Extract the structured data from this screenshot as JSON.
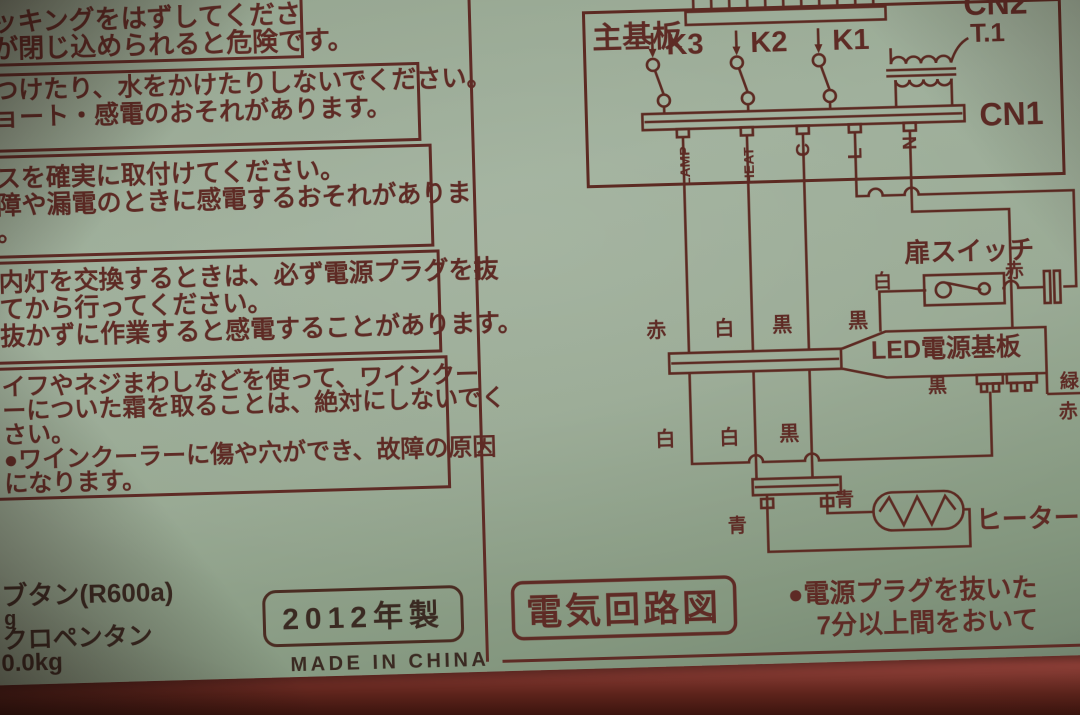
{
  "colors": {
    "label_bg": "#97a892",
    "ink": "#5e2b25",
    "ink_dark": "#3a2a22",
    "appliance_red": "#b4584c"
  },
  "warnings": [
    {
      "lines": [
        "ッキングをはずしてくださ",
        "が閉じ込められると危険です。"
      ]
    },
    {
      "lines": [
        "つけたり、水をかけたりしないでください。",
        "ョート・感電のおそれがあります。"
      ]
    },
    {
      "lines": [
        "スを確実に取付けてください。",
        "障や漏電のときに感電するおそれがありま",
        "。"
      ]
    },
    {
      "lines": [
        "内灯を交換するときは、必ず電源プラグを抜",
        "てから行ってください。",
        "抜かずに作業すると感電することがあります。"
      ]
    },
    {
      "lines": [
        "イフやネジまわしなどを使って、ワインクー",
        "ーについた霜を取ることは、絶対にしないでく",
        "さい。",
        "●ワインクーラーに傷や穴ができ、故障の原因",
        "になります。"
      ]
    }
  ],
  "specs": {
    "line1": "ブタン(R600a)",
    "line2": "g",
    "line3": "クロペンタン",
    "line4": "0.0kg"
  },
  "manufacture": {
    "year": "2012年製",
    "origin": "MADE IN CHINA"
  },
  "circuit": {
    "title": "電気回路図",
    "main_board": "主基板",
    "cn2": "CN2",
    "cn1": "CN1",
    "transformer": "T.1",
    "relays": [
      "K3",
      "K2",
      "K1"
    ],
    "pins": [
      "LAMP",
      "HEAT",
      "C",
      "L",
      "N"
    ],
    "wire_row1": [
      "赤",
      "白",
      "黒",
      "黒"
    ],
    "wire_row2": [
      "白",
      "白",
      "黒"
    ],
    "door_switch": {
      "label": "扉スイッチ",
      "white": "白",
      "red": "赤"
    },
    "led_board": {
      "label": "LED電源基板",
      "black": "黒",
      "green": "緑",
      "red": "赤"
    },
    "heater": {
      "label": "ヒーター",
      "blue1": "青",
      "blue2": "青"
    },
    "note": [
      "●電源プラグを抜いた",
      "7分以上間をおいて"
    ]
  }
}
